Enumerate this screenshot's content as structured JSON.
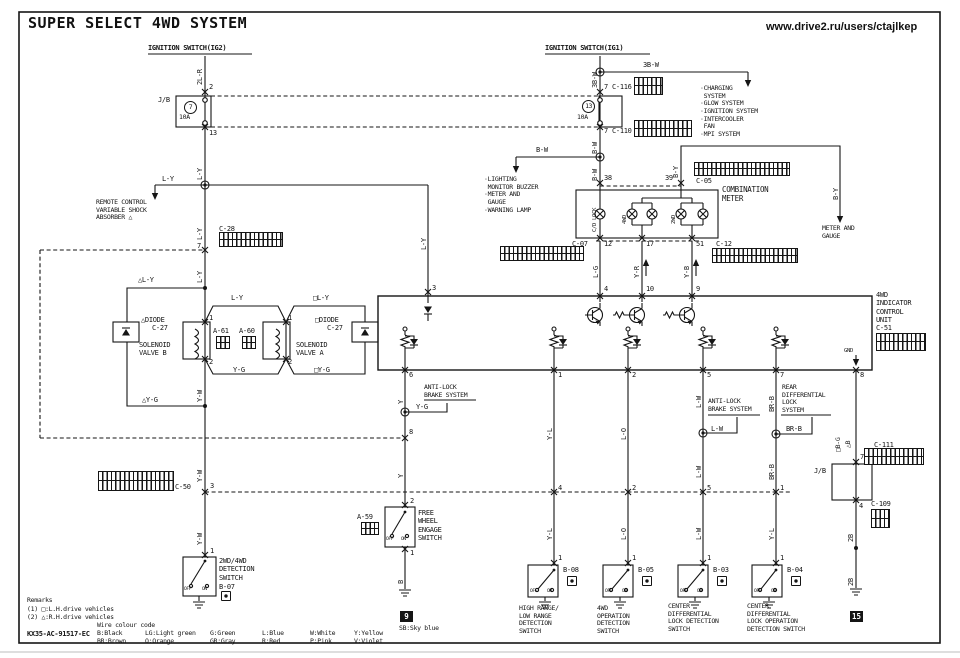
{
  "header": {
    "title": "SUPER SELECT 4WD SYSTEM",
    "credit": "www.drive2.ru/users/ctajlkep",
    "doc_code": "KX35-AC-91517-EC"
  },
  "ignition": {
    "ig2": "IGNITION SWITCH(IG2)",
    "ig1": "IGNITION SWITCH(IG1)"
  },
  "jb": {
    "label": "J/B",
    "fuse_left": "7",
    "fuse_right": "13",
    "amp": "10A"
  },
  "wires": {
    "w2lr": "2L-R",
    "ly": "L-Y",
    "dly": "△L-Y",
    "sly": "□L-Y",
    "yg": "Y-G",
    "syg": "□Y-G",
    "dyg": "△Y-G",
    "yw": "Y-W",
    "w3bw": "3B-W",
    "bw": "B-W",
    "by": "B-Y",
    "lg": "L-G",
    "yr": "Y-R",
    "yb": "Y-B",
    "y": "Y",
    "yl": "Y-L",
    "lo": "L-O",
    "lw": "L-W",
    "brb": "BR-B",
    "sbg": "□B-G",
    "db": "△B",
    "b": "B",
    "w2b": "2B"
  },
  "terminals": {
    "n1": "1",
    "n2": "2",
    "n3": "3",
    "n4": "4",
    "n5": "5",
    "n6": "6",
    "n7": "7",
    "n8": "8",
    "n9": "9",
    "n10": "10",
    "n12": "12",
    "n13": "13",
    "n17": "17",
    "n38": "38",
    "n39": "39",
    "n51": "51"
  },
  "connectors": {
    "c116": "C-116",
    "c110": "C-110",
    "c05": "C-05",
    "c07": "C-07",
    "c12": "C-12",
    "c28": "C-28",
    "c50": "C-50",
    "c51": "C-51",
    "c27": "C-27",
    "c111": "C-111",
    "c109": "C-109",
    "a61": "A-61",
    "a60": "A-60",
    "a59": "A-59",
    "b08": "B-08",
    "b05": "B-05",
    "b03": "B-03",
    "b04": "B-04",
    "b07": "B-07"
  },
  "components": {
    "combination_meter": "COMBINATION\nMETER",
    "cd_lock": "C/D LOCK",
    "lamp_4wd": "4WD",
    "lamp_2wd": "2WD",
    "control_unit": "4WD\nINDICATOR\nCONTROL\nUNIT",
    "gnd": "GND",
    "solenoid_b": "SOLENOID\nVALVE B",
    "solenoid_a": "SOLENOID\nVALVE A",
    "diode_left": "△DIODE",
    "diode_right": "□DIODE",
    "free_wheel": "FREE\nWHEEL\nENGAGE\nSWITCH",
    "sw_2wd4wd": "2WD/4WD\nDETECTION\nSWITCH",
    "sw_hilo": "HIGH RANGE/\nLOW RANGE\nDETECTION\nSWITCH",
    "sw_4wdop": "4WD\nOPERATION\nDETECTION\nSWITCH",
    "sw_cdl": "CENTER\nDIFFERENTIAL\nLOCK DETECTION\nSWITCH",
    "sw_cdlop": "CENTER\nDIFFERENTIAL\nLOCK OPERATION\nDETECTION SWITCH",
    "off": "OFF",
    "on": "ON"
  },
  "systems": {
    "remote_shock": "REMOTE CONTROL\nVARIABLE SHOCK\nABSORBER △",
    "ig1_list": "·CHARGING\n SYSTEM\n·GLOW SYSTEM\n·IGNITION SYSTEM\n·INTERCOOLER\n FAN\n·MPI SYSTEM",
    "bw_list": "·LIGHTING\n MONITOR BUZZER\n·METER AND\n GAUGE\n·WARNING LAMP",
    "meter_gauge": "METER AND\nGAUGE",
    "abs": "ANTI-LOCK\nBRAKE SYSTEM",
    "rear_diff": "REAR\nDIFFERENTIAL\nLOCK\nSYSTEM"
  },
  "grounds": {
    "g9": "9",
    "g15": "15"
  },
  "legend": {
    "remarks": "Remarks",
    "r1": "(1) □:L.H.drive vehicles",
    "r2": "(2) △:R.H.drive vehicles",
    "code_title": "Wire colour code",
    "row1": [
      "B:Black",
      "LG:Light green",
      "G:Green",
      "L:Blue",
      "W:White",
      "Y:Yellow"
    ],
    "row2": [
      "BR:Brown",
      "O:Orange",
      "GR:Gray",
      "R:Red",
      "P:Pink",
      "V:Violet"
    ],
    "sky": "SB:Sky blue"
  }
}
